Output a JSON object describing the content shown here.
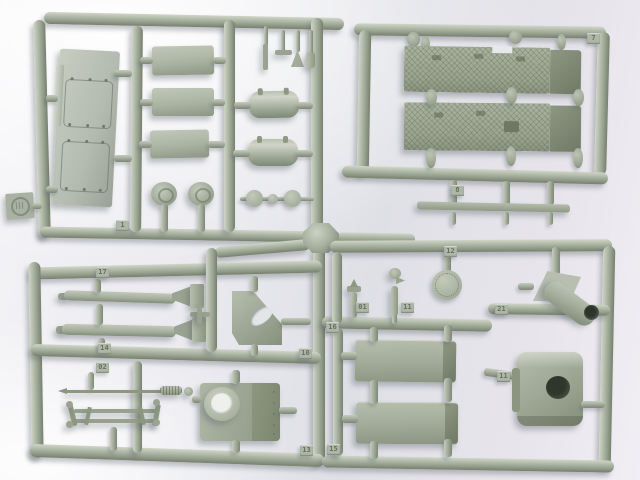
{
  "scene": {
    "title": "Plastic model kit sprue",
    "description": "Photograph of a grey-green injection-moulded sprue (runner frame) holding unassembled military vehicle model parts, lit on a white studio background",
    "material": "grey-green styrene plastic",
    "background": "soft white-to-grey studio backdrop"
  },
  "colors": {
    "plastic_highlight": "#cfd5c7",
    "plastic_mid": "#a4ad9b",
    "plastic_shadow": "#76806d",
    "textured_plate": "#9aa48e",
    "bore_dark": "#30362c",
    "background_light": "#f4f4f7",
    "background_shade": "#dfe0e6"
  },
  "mold_stamp": {
    "shape": "embossed circular maker logo on square tab",
    "legible": false
  },
  "tags": [
    {
      "label": "1"
    },
    {
      "label": "7"
    },
    {
      "label": "8"
    },
    {
      "label": "17"
    },
    {
      "label": "14"
    },
    {
      "label": "02"
    },
    {
      "label": "10"
    },
    {
      "label": "13"
    },
    {
      "label": "12"
    },
    {
      "label": "01"
    },
    {
      "label": "11"
    },
    {
      "label": "16"
    },
    {
      "label": "21"
    },
    {
      "label": "11"
    },
    {
      "label": "15"
    }
  ],
  "parts_inventory": {
    "top_left": [
      "engine-deck plate with twin hatch pairs",
      "rectangular stowage box x3",
      "cylindrical fuel drum x2",
      "ventilator dome x2",
      "wheel disc x3",
      "small muzzle and pin fittings"
    ],
    "top_right": [
      "anti-slip textured fender plate x2",
      "long mounting strip",
      "clamp fittings"
    ],
    "bottom_left": [
      "tapered gun barrel x2",
      "angled bracket plate with cutout",
      "aerial rod",
      "tow-bar rack",
      "turret front plate with ring opening"
    ],
    "bottom_right": [
      "round hatch disc",
      "periscope head",
      "lifting-hook fitting",
      "stowage bin x2",
      "exhaust pipe on triangular base",
      "gun shield with bore opening"
    ]
  }
}
